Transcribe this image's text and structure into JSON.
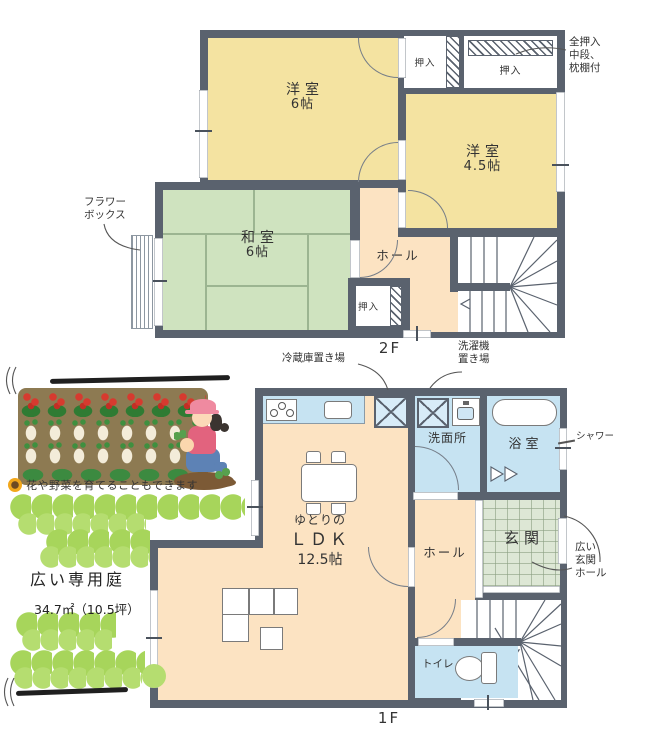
{
  "colors": {
    "wall": "#5a626e",
    "room_yellow": "#f4e3a1",
    "room_green": "#cfe3bf",
    "room_peach": "#fce3c2",
    "room_blue": "#c6e3f2",
    "tile": "#dde7d5",
    "grass": "#a7d55b",
    "soil": "#8d7a52"
  },
  "floor2": {
    "floor_label": "2F",
    "western6": {
      "name": "洋室",
      "size": "6帖"
    },
    "western45": {
      "name": "洋室",
      "size": "4.5帖"
    },
    "japanese6": {
      "name": "和室",
      "size": "6帖"
    },
    "hall_label": "ホール",
    "closet_top_left": "押入",
    "closet_top_right": "押入",
    "closet_bottom": "押入",
    "flower_note": {
      "line1": "フラワー",
      "line2": "ボックス"
    },
    "closet_note": {
      "line1": "全押入",
      "line2": "中段、",
      "line3": "枕棚付"
    }
  },
  "floor1": {
    "floor_label": "1F",
    "ldk": {
      "prefix": "ゆとりの",
      "name": "ＬＤＫ",
      "size": "12.5帖"
    },
    "washroom_label": "洗面所",
    "bathroom_label": "浴室",
    "hall_label": "ホール",
    "entrance_label": "玄関",
    "toilet_label": "トイレ",
    "fridge_note": "冷蔵庫置き場",
    "washer_note": {
      "line1": "洗濯機",
      "line2": "置き場"
    },
    "shower_note": "シャワー",
    "entrance_note": {
      "line1": "広い",
      "line2": "玄関",
      "line3": "ホール"
    }
  },
  "garden": {
    "caption": "花や野菜を育てることもできます",
    "title": "広い専用庭",
    "area": "34.7㎡（10.5坪）"
  }
}
